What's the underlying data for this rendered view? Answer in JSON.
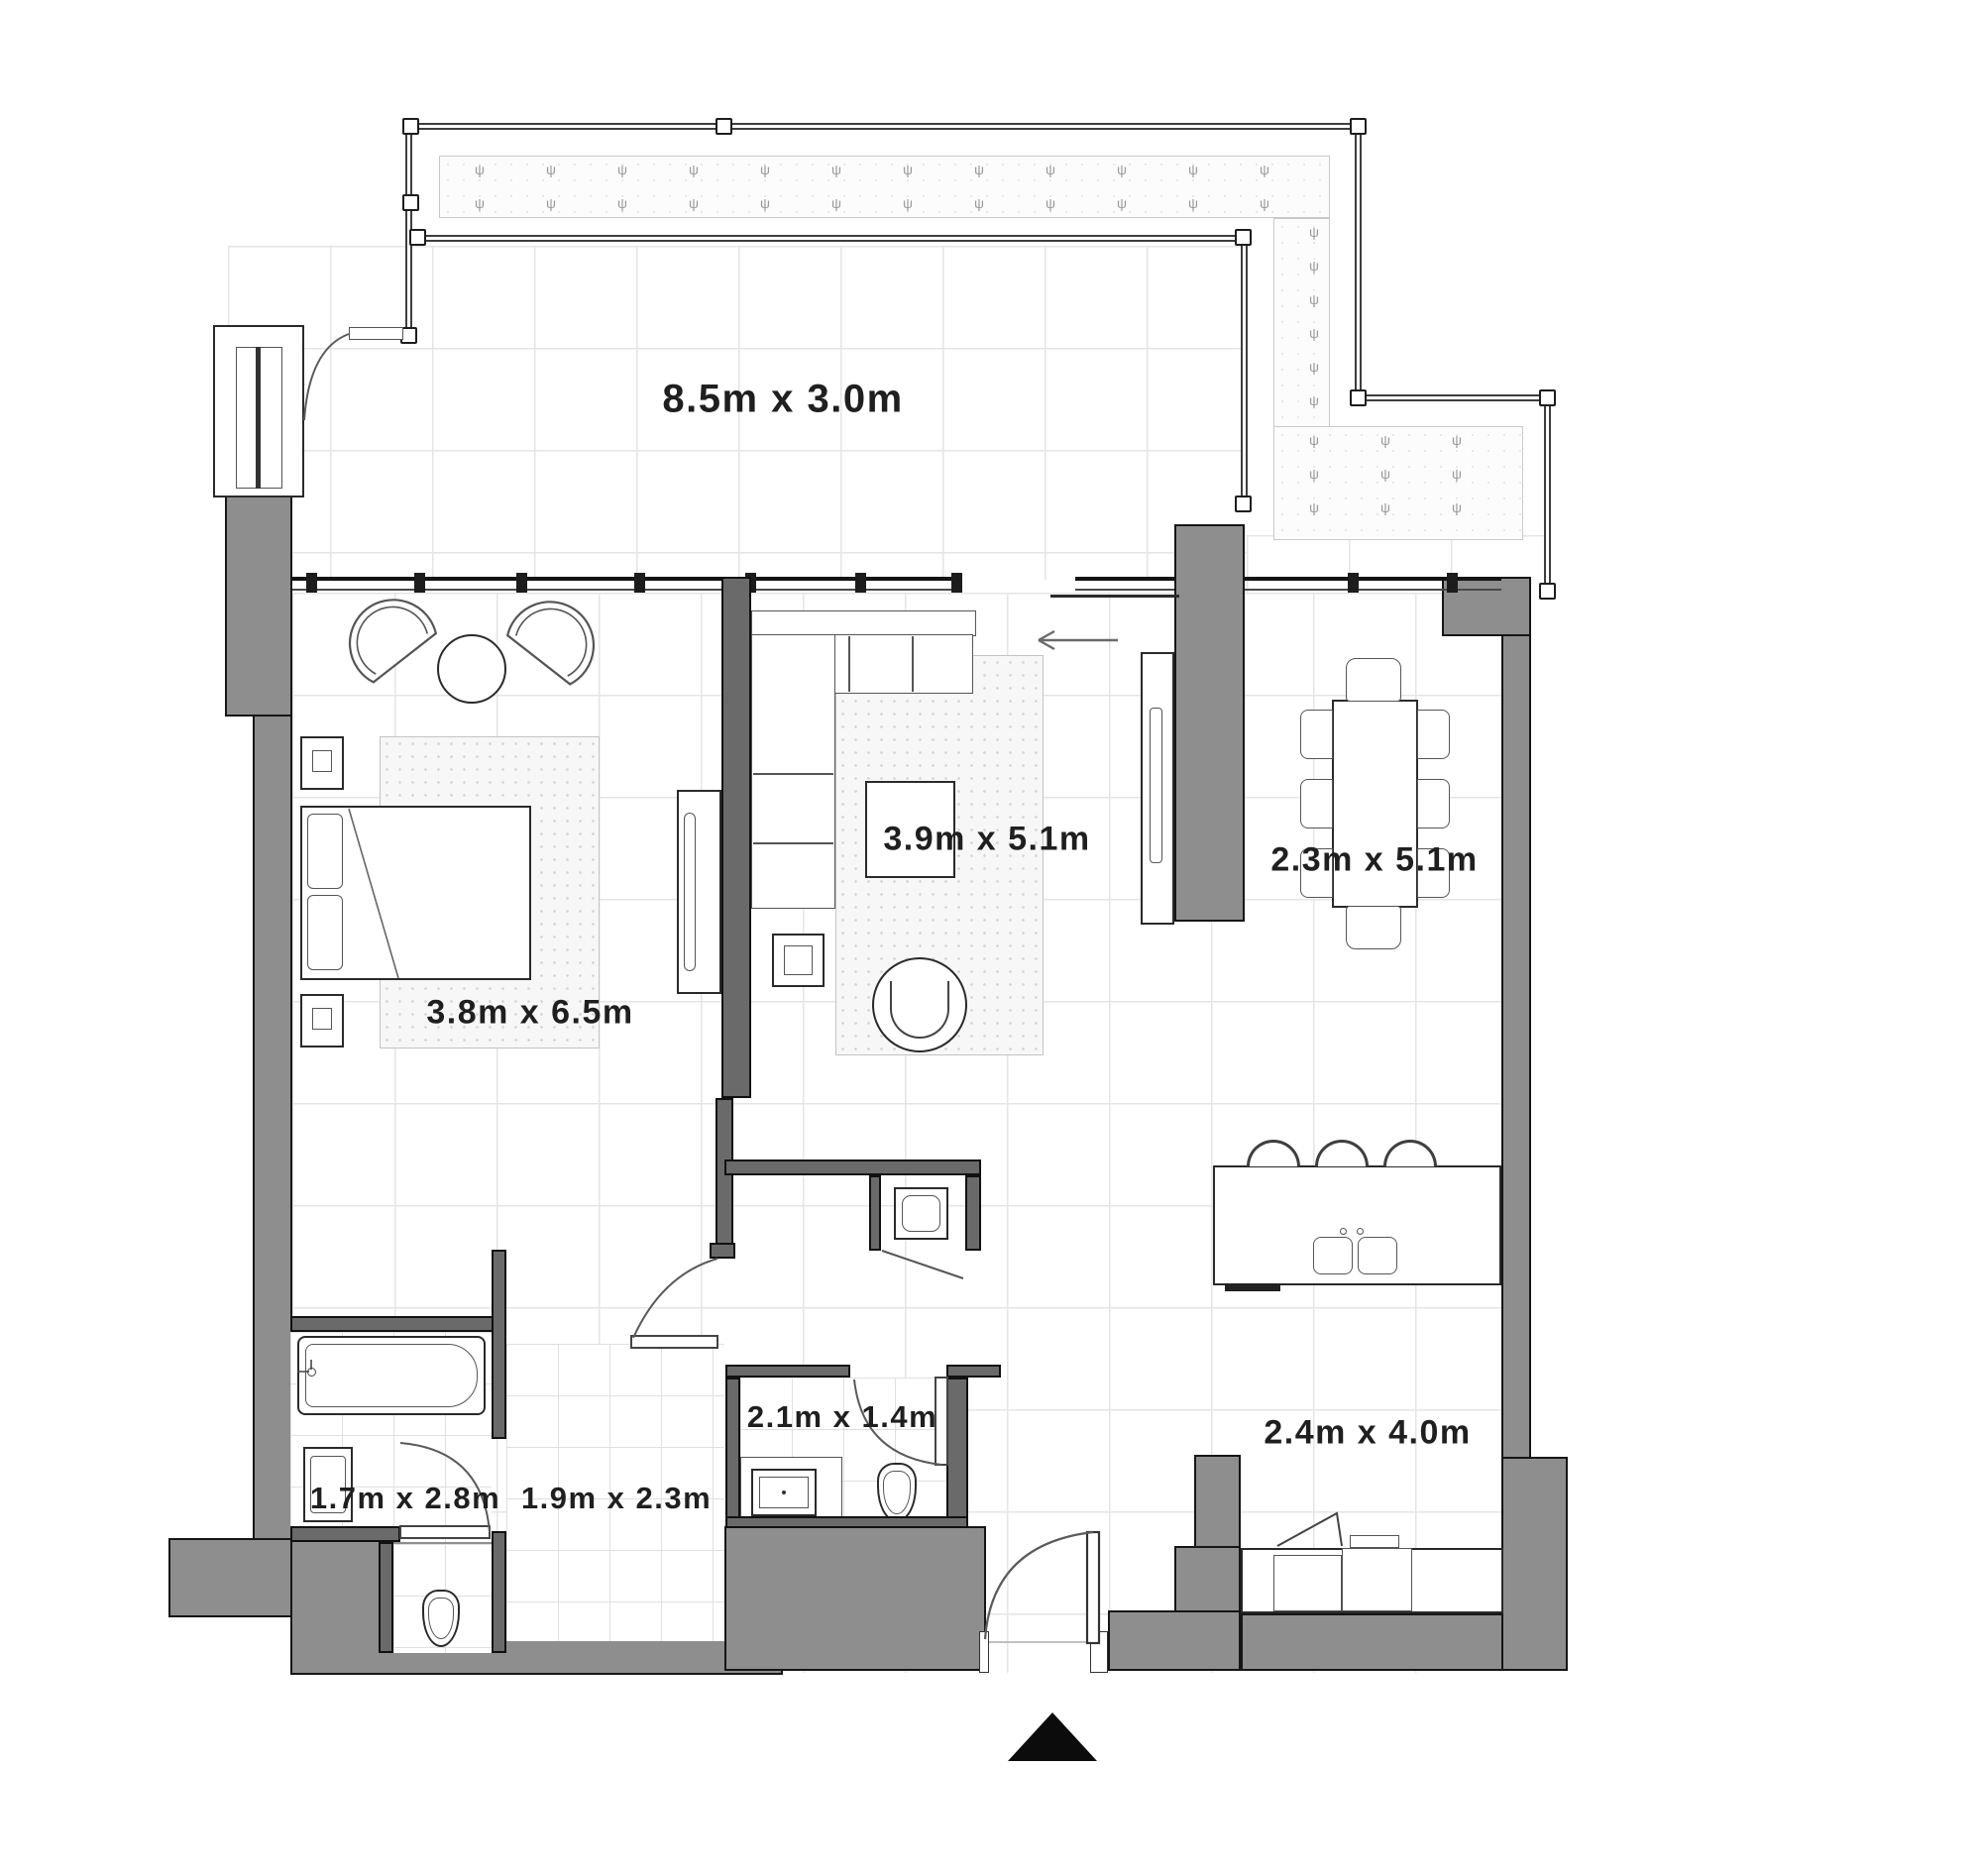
{
  "plan": {
    "type": "apartment-floor-plan",
    "labels": {
      "balcony": "8.5m x 3.0m",
      "bedroom": "3.8m x 6.5m",
      "living": "3.9m x 5.1m",
      "dining": "2.3m x 5.1m",
      "kitchen": "2.4m x 4.0m",
      "bathroom2": "2.1m x 1.4m",
      "ensuite": "1.7m x 2.8m",
      "dressing": "1.9m x 2.3m"
    },
    "colors": {
      "exterior_wall": "#8e8e8e",
      "interior_wall": "#6a6a6a",
      "outline": "#161616",
      "grid_line": "#e5e5e5",
      "text": "#1f1f1f",
      "north_marker": "#0c0c0c"
    },
    "icons": {
      "north": "north-arrow",
      "slide_direction": "left-arrow",
      "plant": "planter-sprig"
    },
    "fixtures": [
      "bed",
      "nightstand",
      "lounge-chair",
      "round-side-table",
      "rug",
      "sectional-sofa",
      "coffee-table",
      "armchair",
      "tv-unit",
      "wardrobe",
      "dining-table",
      "dining-chair",
      "kitchen-island",
      "double-sink",
      "bar-stool",
      "counter",
      "cooktop",
      "oven",
      "washing-machine",
      "bathtub",
      "vanity-sink",
      "toilet",
      "door-swing",
      "railing",
      "planter"
    ]
  }
}
